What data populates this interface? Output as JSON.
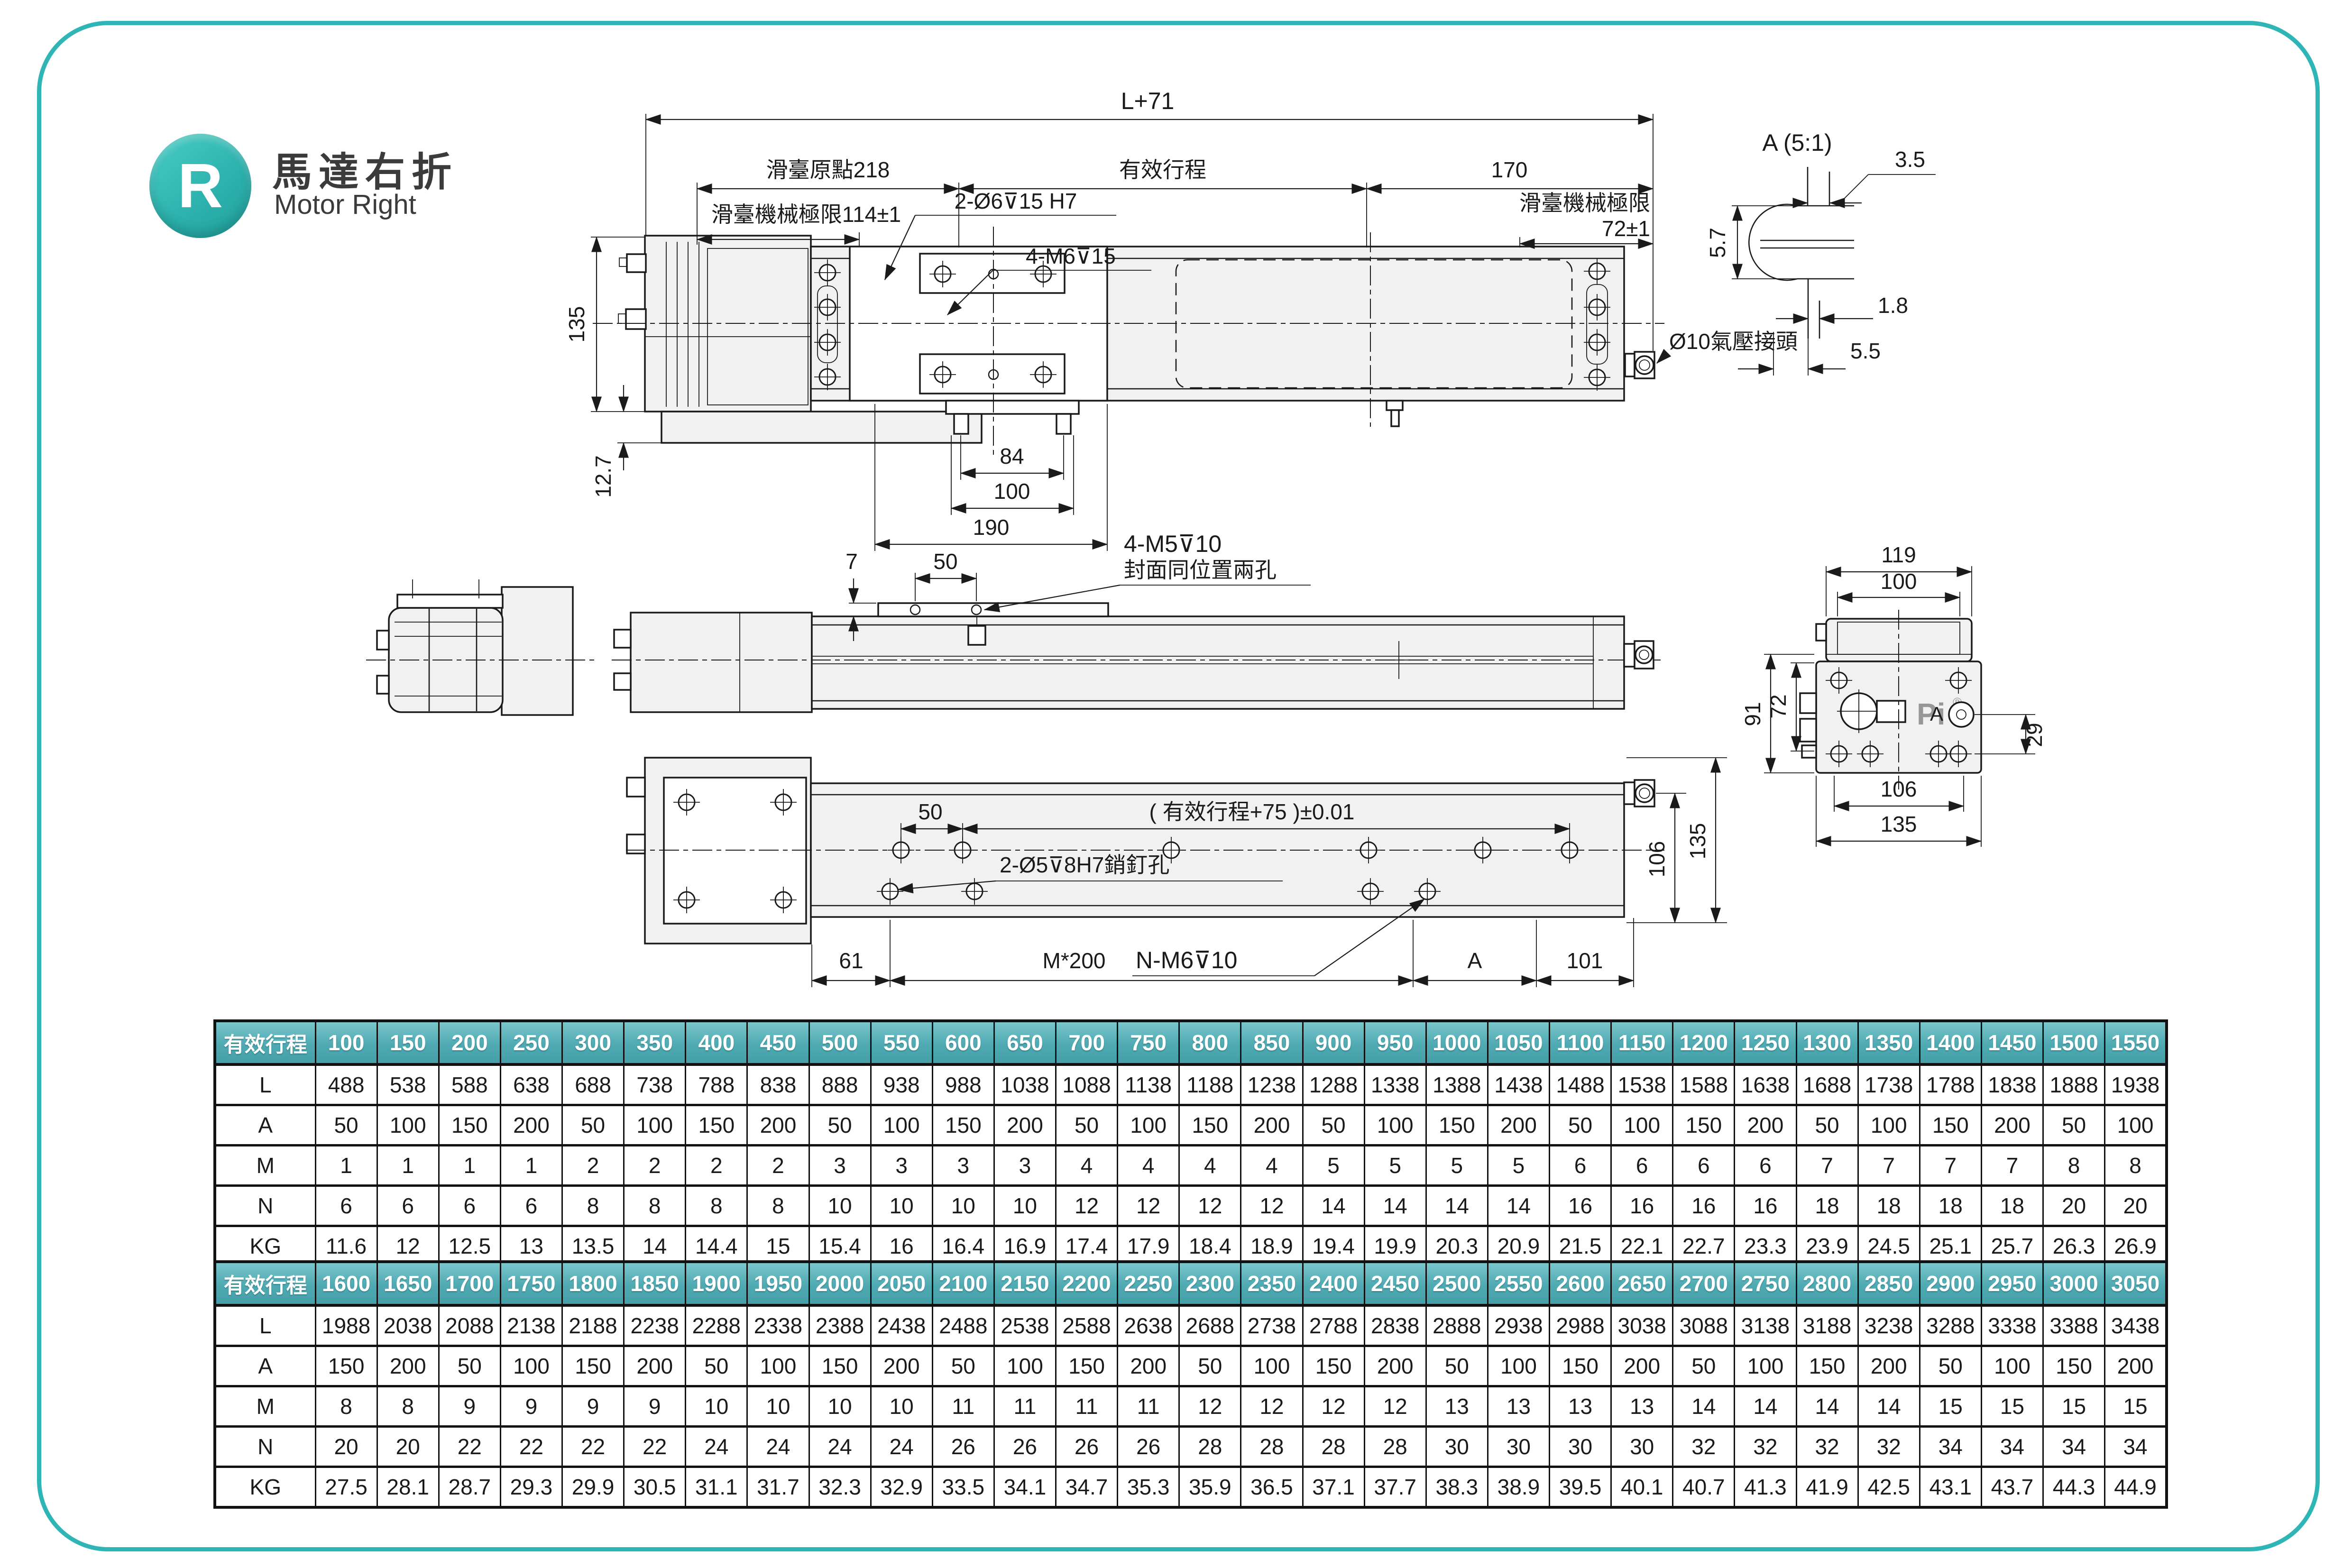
{
  "page": {
    "badge_letter": "R",
    "title_zh": "馬達右折",
    "title_en": "Motor Right",
    "accent_color": "#2FB5B6",
    "table_header_color_top": "#7AC6CB",
    "table_header_color_bottom": "#459FA8"
  },
  "views": {
    "top": {
      "dim_total": "L+71",
      "dim_origin": "滑臺原點218",
      "dim_stroke_label": "有效行程",
      "dim_right_end": "170",
      "note_limit_left": "滑臺機械極限114±1",
      "note_dowel_holes": "2-Ø6⊽15  H7",
      "note_mount_screws": "4-M6⊽15",
      "note_limit_right_line1": "滑臺機械極限",
      "note_limit_right_line2": "72±1",
      "dim_height": "135",
      "dim_base_step": "12.7",
      "dim_feet": "84",
      "dim_holes": "100",
      "dim_plate": "190",
      "note_air_fitting": "Ø10氣壓接頭"
    },
    "detail_a": {
      "title": "A (5:1)",
      "dim_top": "3.5",
      "dim_left": "5.7",
      "dim_step": "1.8",
      "dim_bottom": "5.5"
    },
    "side": {
      "dim_hump": "7",
      "dim_holes": "50",
      "note_screws_line1": "4-M5⊽10",
      "note_screws_line2": "封面同位置兩孔"
    },
    "end": {
      "dim_cover_outer": "119",
      "dim_cover_inner": "100",
      "dim_body_outer": "91",
      "dim_body_inner": "72",
      "dim_fitting": "29",
      "dim_bolts": "106",
      "dim_base": "135",
      "logo": "Pi",
      "reg_mark": "®",
      "detail_label": "A"
    },
    "bottom": {
      "dim_holes": "50",
      "dim_stroke_tol": "( 有效行程+75 )±0.01",
      "note_pin_holes": "2-Ø5⊽8H7銷釘孔",
      "dim_left": "61",
      "dim_pitch": "M*200",
      "note_thread_holes": "N-M6⊽10",
      "dim_a": "A",
      "dim_right": "101",
      "dim_fitting_height": "106",
      "dim_total_height": "135"
    }
  },
  "tables": [
    {
      "header_label": "有效行程",
      "strokes": [
        "100",
        "150",
        "200",
        "250",
        "300",
        "350",
        "400",
        "450",
        "500",
        "550",
        "600",
        "650",
        "700",
        "750",
        "800",
        "850",
        "900",
        "950",
        "1000",
        "1050",
        "1100",
        "1150",
        "1200",
        "1250",
        "1300",
        "1350",
        "1400",
        "1450",
        "1500",
        "1550"
      ],
      "rows": [
        {
          "label": "L",
          "values": [
            "488",
            "538",
            "588",
            "638",
            "688",
            "738",
            "788",
            "838",
            "888",
            "938",
            "988",
            "1038",
            "1088",
            "1138",
            "1188",
            "1238",
            "1288",
            "1338",
            "1388",
            "1438",
            "1488",
            "1538",
            "1588",
            "1638",
            "1688",
            "1738",
            "1788",
            "1838",
            "1888",
            "1938"
          ]
        },
        {
          "label": "A",
          "values": [
            "50",
            "100",
            "150",
            "200",
            "50",
            "100",
            "150",
            "200",
            "50",
            "100",
            "150",
            "200",
            "50",
            "100",
            "150",
            "200",
            "50",
            "100",
            "150",
            "200",
            "50",
            "100",
            "150",
            "200",
            "50",
            "100",
            "150",
            "200",
            "50",
            "100"
          ]
        },
        {
          "label": "M",
          "values": [
            "1",
            "1",
            "1",
            "1",
            "2",
            "2",
            "2",
            "2",
            "3",
            "3",
            "3",
            "3",
            "4",
            "4",
            "4",
            "4",
            "5",
            "5",
            "5",
            "5",
            "6",
            "6",
            "6",
            "6",
            "7",
            "7",
            "7",
            "7",
            "8",
            "8"
          ]
        },
        {
          "label": "N",
          "values": [
            "6",
            "6",
            "6",
            "6",
            "8",
            "8",
            "8",
            "8",
            "10",
            "10",
            "10",
            "10",
            "12",
            "12",
            "12",
            "12",
            "14",
            "14",
            "14",
            "14",
            "16",
            "16",
            "16",
            "16",
            "18",
            "18",
            "18",
            "18",
            "20",
            "20"
          ]
        },
        {
          "label": "KG",
          "values": [
            "11.6",
            "12",
            "12.5",
            "13",
            "13.5",
            "14",
            "14.4",
            "15",
            "15.4",
            "16",
            "16.4",
            "16.9",
            "17.4",
            "17.9",
            "18.4",
            "18.9",
            "19.4",
            "19.9",
            "20.3",
            "20.9",
            "21.5",
            "22.1",
            "22.7",
            "23.3",
            "23.9",
            "24.5",
            "25.1",
            "25.7",
            "26.3",
            "26.9"
          ]
        }
      ]
    },
    {
      "header_label": "有效行程",
      "strokes": [
        "1600",
        "1650",
        "1700",
        "1750",
        "1800",
        "1850",
        "1900",
        "1950",
        "2000",
        "2050",
        "2100",
        "2150",
        "2200",
        "2250",
        "2300",
        "2350",
        "2400",
        "2450",
        "2500",
        "2550",
        "2600",
        "2650",
        "2700",
        "2750",
        "2800",
        "2850",
        "2900",
        "2950",
        "3000",
        "3050"
      ],
      "rows": [
        {
          "label": "L",
          "values": [
            "1988",
            "2038",
            "2088",
            "2138",
            "2188",
            "2238",
            "2288",
            "2338",
            "2388",
            "2438",
            "2488",
            "2538",
            "2588",
            "2638",
            "2688",
            "2738",
            "2788",
            "2838",
            "2888",
            "2938",
            "2988",
            "3038",
            "3088",
            "3138",
            "3188",
            "3238",
            "3288",
            "3338",
            "3388",
            "3438"
          ]
        },
        {
          "label": "A",
          "values": [
            "150",
            "200",
            "50",
            "100",
            "150",
            "200",
            "50",
            "100",
            "150",
            "200",
            "50",
            "100",
            "150",
            "200",
            "50",
            "100",
            "150",
            "200",
            "50",
            "100",
            "150",
            "200",
            "50",
            "100",
            "150",
            "200",
            "50",
            "100",
            "150",
            "200"
          ]
        },
        {
          "label": "M",
          "values": [
            "8",
            "8",
            "9",
            "9",
            "9",
            "9",
            "10",
            "10",
            "10",
            "10",
            "11",
            "11",
            "11",
            "11",
            "12",
            "12",
            "12",
            "12",
            "13",
            "13",
            "13",
            "13",
            "14",
            "14",
            "14",
            "14",
            "15",
            "15",
            "15",
            "15"
          ]
        },
        {
          "label": "N",
          "values": [
            "20",
            "20",
            "22",
            "22",
            "22",
            "22",
            "24",
            "24",
            "24",
            "24",
            "26",
            "26",
            "26",
            "26",
            "28",
            "28",
            "28",
            "28",
            "30",
            "30",
            "30",
            "30",
            "32",
            "32",
            "32",
            "32",
            "34",
            "34",
            "34",
            "34"
          ]
        },
        {
          "label": "KG",
          "values": [
            "27.5",
            "28.1",
            "28.7",
            "29.3",
            "29.9",
            "30.5",
            "31.1",
            "31.7",
            "32.3",
            "32.9",
            "33.5",
            "34.1",
            "34.7",
            "35.3",
            "35.9",
            "36.5",
            "37.1",
            "37.7",
            "38.3",
            "38.9",
            "39.5",
            "40.1",
            "40.7",
            "41.3",
            "41.9",
            "42.5",
            "43.1",
            "43.7",
            "44.3",
            "44.9"
          ]
        }
      ]
    }
  ]
}
